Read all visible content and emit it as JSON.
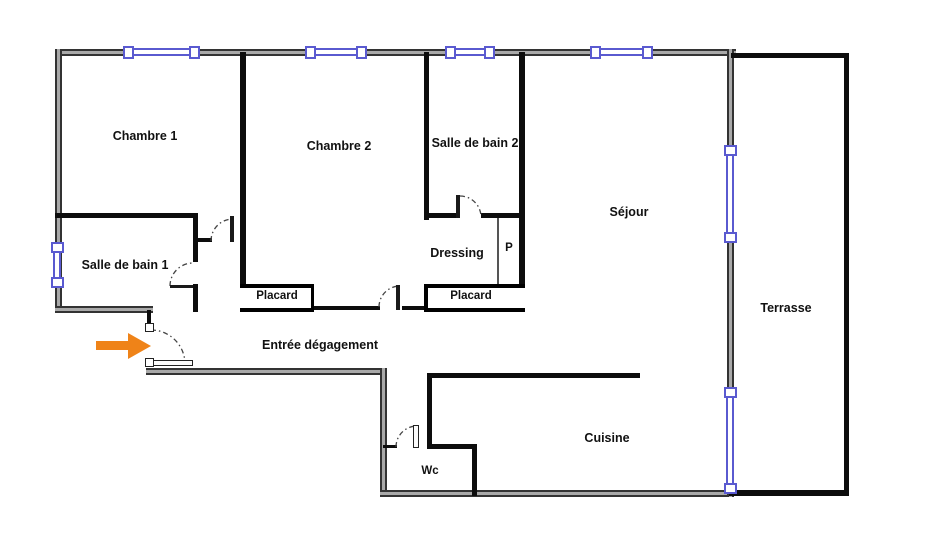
{
  "plan_title": "apartment-floor-plan",
  "rooms": {
    "chambre1": {
      "label": "Chambre 1"
    },
    "chambre2": {
      "label": "Chambre 2"
    },
    "sdb2": {
      "label": "Salle de bain 2"
    },
    "sejour": {
      "label": "Séjour"
    },
    "sdb1": {
      "label": "Salle de bain 1"
    },
    "dressing": {
      "label": "Dressing"
    },
    "p": {
      "label": "P"
    },
    "placard_left": {
      "label": "Placard"
    },
    "placard_right": {
      "label": "Placard"
    },
    "entree": {
      "label": "Entrée dégagement"
    },
    "terrasse": {
      "label": "Terrasse"
    },
    "cuisine": {
      "label": "Cuisine"
    },
    "wc": {
      "label": "Wc"
    }
  },
  "colors": {
    "window_blue": "#5a5ad0",
    "wall_black": "#0d0d0d",
    "wall_gray_edge": "#333333",
    "wall_gray_fill": "#a9a9a9",
    "entrance_arrow_orange": "#ef8318",
    "background": "#ffffff"
  }
}
